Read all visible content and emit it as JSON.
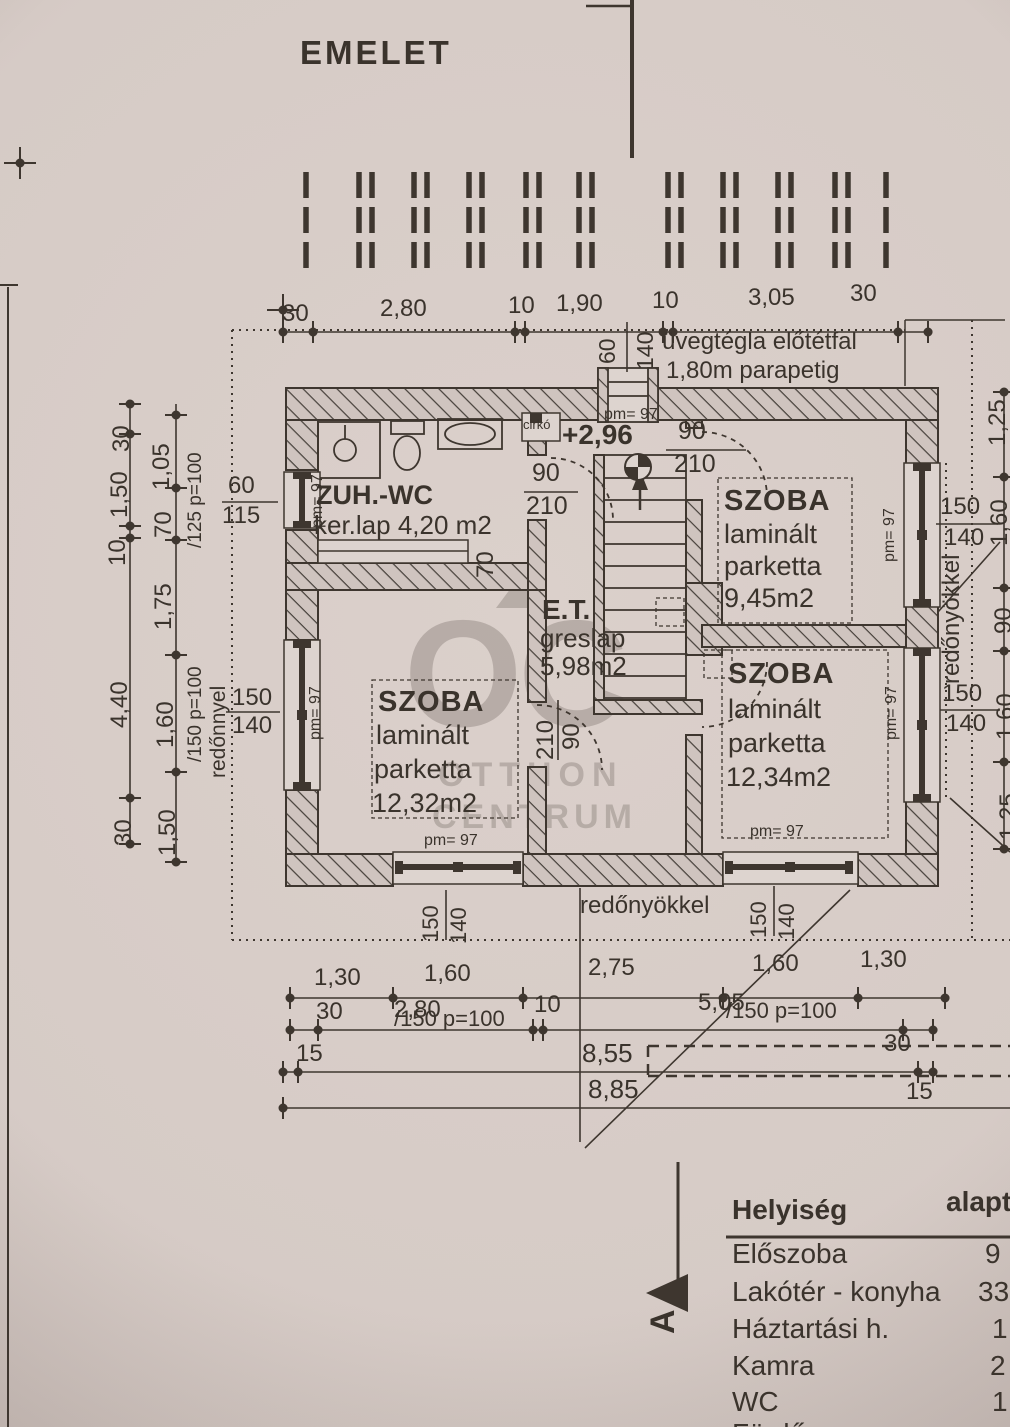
{
  "page": {
    "title": "EMELET"
  },
  "watermark": {
    "logo": "OC",
    "line1": "OTTHON",
    "line2": "CENTRUM"
  },
  "rooms": {
    "bath": {
      "name": "ZUH.-WC",
      "detail": "ker.lap 4,20 m2"
    },
    "et": {
      "name": "E.T.",
      "finish": "greslap",
      "area": "5,98m2"
    },
    "szoba_tr": {
      "name": "SZOBA",
      "l1": "laminált",
      "l2": "parketta",
      "area": "9,45m2"
    },
    "szoba_br": {
      "name": "SZOBA",
      "l1": "laminált",
      "l2": "parketta",
      "area": "12,34m2"
    },
    "szoba_l": {
      "name": "SZOBA",
      "l1": "laminált",
      "l2": "parketta",
      "area": "12,32m2"
    }
  },
  "annotations": {
    "glass1": "üvegtégla előtétfal",
    "glass2": "1,80m parapetig",
    "level": "+2,96",
    "cirko": "cirkó",
    "pm97": "pm= 97",
    "redonnyel": "redőnnyel",
    "redonyokkel": "redőnyökkel",
    "p125": "/125 p=100",
    "p150": "/150 p=100",
    "section": "A"
  },
  "dims": {
    "top": [
      "30",
      "2,80",
      "10",
      "1,90",
      "10",
      "3,05",
      "30"
    ],
    "left_outer": [
      "30",
      "1,50",
      "10",
      "4,40",
      "30"
    ],
    "left_inner": [
      "1,05",
      "70",
      "1,75",
      "1,60",
      "1,50"
    ],
    "left_win_small": [
      "60",
      "115"
    ],
    "left_win": [
      "150",
      "140"
    ],
    "right_chain": [
      "1,25",
      "1,60",
      "90",
      "1,60",
      "1,25"
    ],
    "right_win_top": [
      "150",
      "140"
    ],
    "right_win_bottom": [
      "150",
      "140"
    ],
    "bottom_row1": [
      "1,30",
      "1,60",
      "2,75",
      "1,60",
      "1,30"
    ],
    "bottom_row2": [
      "30",
      "2,80",
      "10",
      "5,05",
      "30"
    ],
    "bottom_totals": [
      "8,55",
      "8,85"
    ],
    "bottom_off": [
      "15",
      "15"
    ],
    "stair_win": [
      "60",
      "140"
    ],
    "door_bath": [
      "90",
      "210"
    ],
    "door_tr": [
      "90",
      "210"
    ],
    "door_l": [
      "210",
      "90"
    ],
    "wall_nib": "70"
  },
  "table": {
    "col1": "Helyiség",
    "col2": "alapt",
    "rows": [
      {
        "name": "Előszoba",
        "value": "9"
      },
      {
        "name": "Lakótér - konyha",
        "value": "33"
      },
      {
        "name": "Háztartási h.",
        "value": "1"
      },
      {
        "name": "Kamra",
        "value": "2"
      },
      {
        "name": "WC",
        "value": "1"
      },
      {
        "name": "Fürdő",
        "value": ""
      }
    ]
  }
}
